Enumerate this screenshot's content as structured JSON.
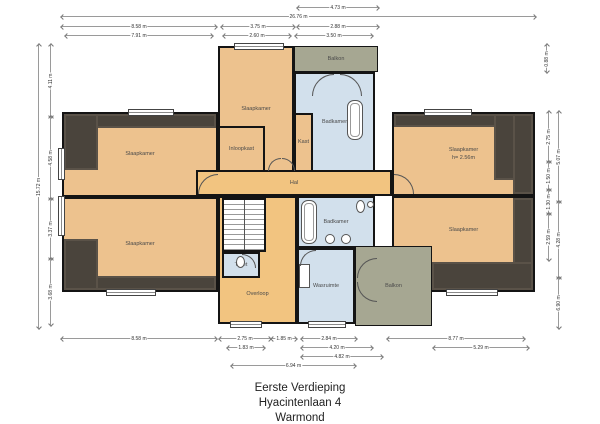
{
  "title": {
    "line1": "Eerste Verdieping",
    "line2": "Hyacintenlaan 4",
    "line3": "Warmond"
  },
  "rooms": {
    "bedroom_nw": {
      "label": "Slaapkamer"
    },
    "bedroom_sw": {
      "label": "Slaapkamer"
    },
    "bedroom_n": {
      "label": "Slaapkamer"
    },
    "bedroom_ne": {
      "label": "Slaapkamer",
      "height_note": "h= 2.56m"
    },
    "bedroom_se": {
      "label": "Slaapkamer"
    },
    "walkin_closet": {
      "label": "Inloopkast"
    },
    "closet": {
      "label": "Kast"
    },
    "bathroom_n": {
      "label": "Badkamer"
    },
    "bathroom_s": {
      "label": "Badkamer"
    },
    "balcony_n": {
      "label": "Balkon"
    },
    "balcony_se": {
      "label": "Balkon"
    },
    "hall": {
      "label": "Hal"
    },
    "landing": {
      "label": "Overloop"
    },
    "toilet": {
      "label": "Toilet"
    },
    "laundry": {
      "label": "Wasruimte"
    }
  },
  "colors": {
    "room_tan": "#edc28e",
    "hall_tan": "#f2c480",
    "wet_blue": "#d2e0ec",
    "balcony_green": "#a6a792",
    "attic_gray": "#4a443c",
    "wall_black": "#141414"
  },
  "dimensions": {
    "horizontal": [
      {
        "label": "4.73 m",
        "x1": 298,
        "x2": 378,
        "y": 7
      },
      {
        "label": "26.76 m",
        "x1": 62,
        "x2": 535,
        "y": 16
      },
      {
        "label": "8.58 m",
        "x1": 62,
        "x2": 216,
        "y": 26
      },
      {
        "label": "3.75 m",
        "x1": 222,
        "x2": 294,
        "y": 26
      },
      {
        "label": "2.88 m",
        "x1": 298,
        "x2": 378,
        "y": 26
      },
      {
        "label": "7.91 m",
        "x1": 66,
        "x2": 212,
        "y": 35
      },
      {
        "label": "2.60 m",
        "x1": 224,
        "x2": 290,
        "y": 35
      },
      {
        "label": "3.50 m",
        "x1": 296,
        "x2": 372,
        "y": 35
      },
      {
        "label": "8.58 m",
        "x1": 62,
        "x2": 216,
        "y": 338
      },
      {
        "label": "2.75 m",
        "x1": 220,
        "x2": 270,
        "y": 338
      },
      {
        "label": "1.85 m",
        "x1": 272,
        "x2": 296,
        "y": 338
      },
      {
        "label": "2.84 m",
        "x1": 302,
        "x2": 356,
        "y": 338
      },
      {
        "label": "8.77 m",
        "x1": 388,
        "x2": 524,
        "y": 338
      },
      {
        "label": "1.83 m",
        "x1": 228,
        "x2": 264,
        "y": 347
      },
      {
        "label": "4.20 m",
        "x1": 302,
        "x2": 372,
        "y": 347
      },
      {
        "label": "5.29 m",
        "x1": 434,
        "x2": 528,
        "y": 347
      },
      {
        "label": "4.82 m",
        "x1": 302,
        "x2": 382,
        "y": 356
      },
      {
        "label": "6.94 m",
        "x1": 232,
        "x2": 355,
        "y": 365
      }
    ],
    "vertical": [
      {
        "label": "15.72 m",
        "x": 38,
        "y1": 45,
        "y2": 328
      },
      {
        "label": "4.11 m",
        "x": 50,
        "y1": 45,
        "y2": 117
      },
      {
        "label": "4.58 m",
        "x": 50,
        "y1": 117,
        "y2": 199
      },
      {
        "label": "3.37 m",
        "x": 50,
        "y1": 199,
        "y2": 259
      },
      {
        "label": "3.68 m",
        "x": 50,
        "y1": 259,
        "y2": 325
      },
      {
        "label": "0.88 m",
        "x": 546,
        "y1": 45,
        "y2": 72
      },
      {
        "label": "2.75 m",
        "x": 548,
        "y1": 112,
        "y2": 162
      },
      {
        "label": "1.50 m",
        "x": 548,
        "y1": 162,
        "y2": 190
      },
      {
        "label": "1.30 m",
        "x": 548,
        "y1": 190,
        "y2": 214
      },
      {
        "label": "2.59 m",
        "x": 548,
        "y1": 214,
        "y2": 260
      },
      {
        "label": "5.07 m",
        "x": 558,
        "y1": 112,
        "y2": 202
      },
      {
        "label": "4.28 m",
        "x": 558,
        "y1": 202,
        "y2": 278
      },
      {
        "label": "6.90 m",
        "x": 558,
        "y1": 278,
        "y2": 328
      }
    ]
  }
}
